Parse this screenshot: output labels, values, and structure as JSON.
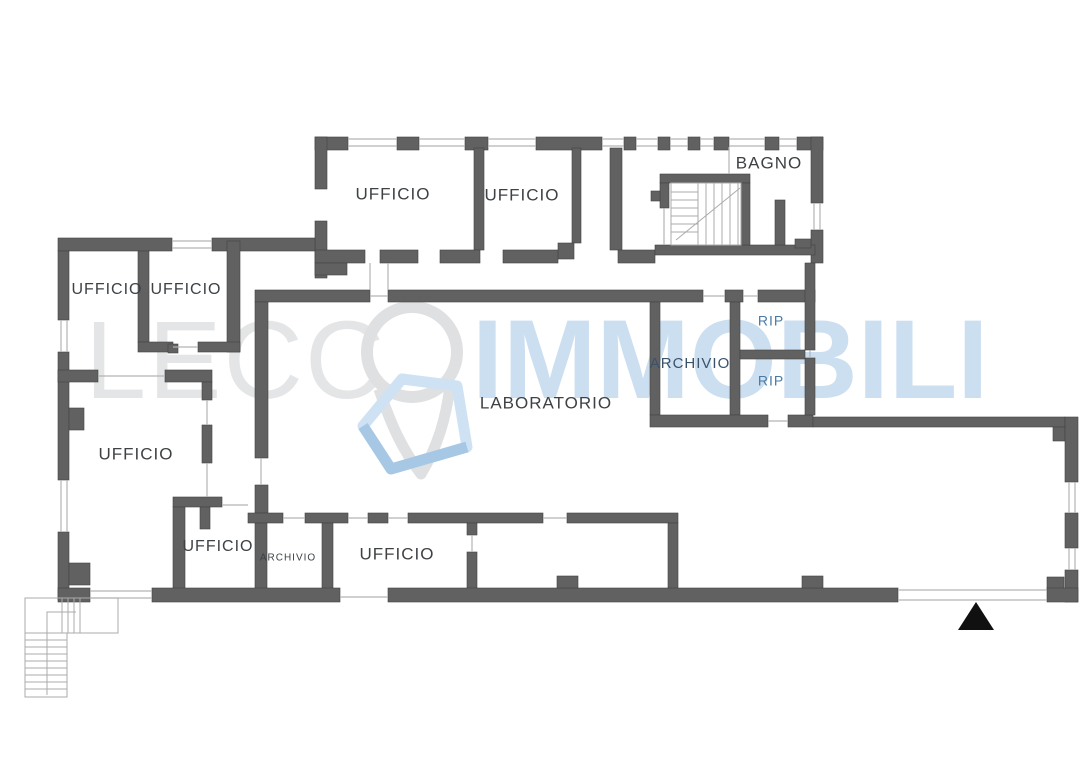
{
  "canvas": {
    "w": 1086,
    "h": 768,
    "bg": "#ffffff"
  },
  "watermark": {
    "word_gray": "LECC",
    "word_blue": "IMMOBILI",
    "gray_color": "#e4e5e6",
    "blue_color": "#cbdff1",
    "pin_color": "#dfe0e2",
    "house_light": "#cfe2f3",
    "house_dark": "#a6c8e5"
  },
  "colors": {
    "wall": "#616161",
    "wall_stroke": "#424242",
    "thin": "#b3b3b3",
    "stair": "#ababab",
    "label": "#3e4245",
    "label_blue": "#4a7ba6",
    "label_slate": "#3a536b",
    "triangle": "#101010"
  },
  "rooms": [
    {
      "label": "UFFICIO",
      "x": 393,
      "y": 195,
      "size": 17,
      "color": "label"
    },
    {
      "label": "UFFICIO",
      "x": 522,
      "y": 196,
      "size": 17,
      "color": "label"
    },
    {
      "label": "BAGNO",
      "x": 769,
      "y": 164,
      "size": 17,
      "color": "label"
    },
    {
      "label": "UFFICIO",
      "x": 107,
      "y": 290,
      "size": 16,
      "color": "label"
    },
    {
      "label": "UFFICIO",
      "x": 186,
      "y": 290,
      "size": 16,
      "color": "label"
    },
    {
      "label": "UFFICIO",
      "x": 136,
      "y": 455,
      "size": 17,
      "color": "label"
    },
    {
      "label": "LABORATORIO",
      "x": 546,
      "y": 404,
      "size": 17,
      "color": "label"
    },
    {
      "label": "ARCHIVIO",
      "x": 690,
      "y": 364,
      "size": 15,
      "color": "label_slate"
    },
    {
      "label": "RIP",
      "x": 771,
      "y": 322,
      "size": 14,
      "color": "label_blue"
    },
    {
      "label": "RIP",
      "x": 771,
      "y": 382,
      "size": 14,
      "color": "label_blue"
    },
    {
      "label": "UFFICIO",
      "x": 218,
      "y": 547,
      "size": 16,
      "color": "label"
    },
    {
      "label": "ARCHIVIO",
      "x": 288,
      "y": 558,
      "size": 10,
      "color": "label"
    },
    {
      "label": "UFFICIO",
      "x": 397,
      "y": 555,
      "size": 17,
      "color": "label"
    }
  ],
  "floorplan": {
    "walls": [
      [
        315,
        137,
        33,
        13
      ],
      [
        397,
        137,
        22,
        13
      ],
      [
        465,
        137,
        23,
        13
      ],
      [
        536,
        137,
        66,
        13
      ],
      [
        624,
        137,
        12,
        13
      ],
      [
        658,
        137,
        12,
        13
      ],
      [
        688,
        137,
        12,
        13
      ],
      [
        714,
        137,
        15,
        13
      ],
      [
        765,
        137,
        14,
        13
      ],
      [
        797,
        137,
        26,
        13
      ],
      [
        315,
        137,
        12,
        52
      ],
      [
        315,
        221,
        12,
        57
      ],
      [
        811,
        137,
        12,
        66
      ],
      [
        811,
        230,
        12,
        33
      ],
      [
        474,
        148,
        10,
        102
      ],
      [
        572,
        148,
        9,
        95
      ],
      [
        558,
        243,
        16,
        16
      ],
      [
        610,
        148,
        12,
        102
      ],
      [
        315,
        250,
        50,
        13
      ],
      [
        380,
        250,
        38,
        13
      ],
      [
        440,
        250,
        40,
        13
      ],
      [
        503,
        250,
        55,
        13
      ],
      [
        618,
        250,
        37,
        13
      ],
      [
        655,
        245,
        160,
        10
      ],
      [
        660,
        174,
        90,
        9
      ],
      [
        660,
        183,
        9,
        25
      ],
      [
        741,
        183,
        9,
        62
      ],
      [
        651,
        191,
        9,
        10
      ],
      [
        775,
        200,
        10,
        45
      ],
      [
        795,
        239,
        16,
        9
      ],
      [
        58,
        238,
        114,
        13
      ],
      [
        212,
        238,
        103,
        13
      ],
      [
        315,
        263,
        32,
        12
      ],
      [
        58,
        251,
        11,
        69
      ],
      [
        58,
        352,
        11,
        128
      ],
      [
        58,
        532,
        11,
        68
      ],
      [
        69,
        408,
        15,
        22
      ],
      [
        69,
        563,
        21,
        22
      ],
      [
        138,
        251,
        11,
        91
      ],
      [
        227,
        241,
        13,
        111
      ],
      [
        138,
        342,
        35,
        10
      ],
      [
        198,
        342,
        42,
        10
      ],
      [
        168,
        344,
        10,
        9
      ],
      [
        58,
        370,
        40,
        12
      ],
      [
        165,
        370,
        47,
        12
      ],
      [
        202,
        382,
        10,
        18
      ],
      [
        202,
        425,
        10,
        38
      ],
      [
        173,
        497,
        49,
        10
      ],
      [
        173,
        507,
        12,
        86
      ],
      [
        200,
        507,
        10,
        22
      ],
      [
        255,
        290,
        115,
        12
      ],
      [
        388,
        290,
        315,
        12
      ],
      [
        725,
        290,
        18,
        12
      ],
      [
        758,
        290,
        57,
        12
      ],
      [
        255,
        302,
        13,
        156
      ],
      [
        255,
        485,
        13,
        28
      ],
      [
        248,
        513,
        35,
        10
      ],
      [
        305,
        513,
        43,
        10
      ],
      [
        368,
        513,
        20,
        10
      ],
      [
        408,
        513,
        135,
        10
      ],
      [
        567,
        513,
        111,
        10
      ],
      [
        255,
        523,
        12,
        70
      ],
      [
        322,
        523,
        11,
        70
      ],
      [
        467,
        523,
        10,
        12
      ],
      [
        467,
        552,
        10,
        41
      ],
      [
        668,
        523,
        10,
        70
      ],
      [
        650,
        302,
        10,
        113
      ],
      [
        730,
        302,
        10,
        113
      ],
      [
        740,
        350,
        65,
        9
      ],
      [
        650,
        415,
        118,
        12
      ],
      [
        788,
        415,
        25,
        12
      ],
      [
        805,
        263,
        10,
        87
      ],
      [
        805,
        358,
        10,
        57
      ],
      [
        813,
        417,
        252,
        10
      ],
      [
        1053,
        427,
        12,
        14
      ],
      [
        1047,
        577,
        17,
        13
      ],
      [
        1065,
        417,
        13,
        65
      ],
      [
        1065,
        513,
        13,
        35
      ],
      [
        1065,
        570,
        13,
        32
      ],
      [
        58,
        588,
        32,
        14
      ],
      [
        152,
        588,
        188,
        14
      ],
      [
        388,
        588,
        510,
        14
      ],
      [
        1047,
        588,
        31,
        14
      ],
      [
        557,
        576,
        21,
        12
      ],
      [
        802,
        576,
        21,
        12
      ]
    ],
    "thin_h": [
      [
        348,
        397,
        139
      ],
      [
        348,
        397,
        146
      ],
      [
        419,
        465,
        139
      ],
      [
        419,
        465,
        146
      ],
      [
        488,
        536,
        139
      ],
      [
        488,
        536,
        146
      ],
      [
        602,
        624,
        139
      ],
      [
        602,
        624,
        146
      ],
      [
        636,
        658,
        139
      ],
      [
        636,
        658,
        146
      ],
      [
        670,
        688,
        139
      ],
      [
        670,
        688,
        146
      ],
      [
        700,
        714,
        139
      ],
      [
        700,
        714,
        146
      ],
      [
        729,
        765,
        139
      ],
      [
        729,
        765,
        146
      ],
      [
        779,
        797,
        139
      ],
      [
        779,
        797,
        146
      ],
      [
        172,
        212,
        241
      ],
      [
        172,
        212,
        248
      ],
      [
        90,
        152,
        591
      ],
      [
        90,
        152,
        598
      ],
      [
        340,
        388,
        597
      ],
      [
        898,
        1047,
        590
      ],
      [
        898,
        1047,
        600
      ],
      [
        98,
        165,
        376
      ],
      [
        173,
        198,
        347
      ],
      [
        222,
        248,
        505
      ],
      [
        283,
        305,
        518
      ],
      [
        348,
        368,
        518
      ],
      [
        388,
        408,
        518
      ],
      [
        543,
        567,
        518
      ],
      [
        768,
        788,
        421
      ],
      [
        370,
        388,
        296
      ],
      [
        703,
        725,
        296
      ],
      [
        743,
        758,
        296
      ]
    ],
    "thin_v": [
      [
        61,
        320,
        352
      ],
      [
        67,
        320,
        352
      ],
      [
        61,
        480,
        532
      ],
      [
        67,
        480,
        532
      ],
      [
        814,
        203,
        230
      ],
      [
        820,
        203,
        230
      ],
      [
        1069,
        482,
        513
      ],
      [
        1075,
        482,
        513
      ],
      [
        1069,
        548,
        570
      ],
      [
        1075,
        548,
        570
      ],
      [
        729,
        147,
        174
      ],
      [
        370,
        263,
        290
      ],
      [
        388,
        263,
        290
      ],
      [
        261,
        458,
        485
      ],
      [
        207,
        400,
        425
      ],
      [
        207,
        463,
        497
      ],
      [
        472,
        535,
        552
      ],
      [
        810,
        350,
        358
      ],
      [
        664,
        208,
        245
      ]
    ],
    "stairwell": {
      "inner": [
        671,
        183,
        70,
        62
      ],
      "v_lines": [
        698,
        706,
        714,
        722,
        730,
        738
      ],
      "v_span": [
        183,
        245
      ],
      "h_lines": [
        192,
        200,
        208,
        216,
        224,
        232
      ],
      "h_span": [
        671,
        698
      ],
      "diag": [
        676,
        240,
        740,
        188
      ]
    },
    "ext_stairs": {
      "landing": [
        25,
        598,
        93,
        35
      ],
      "run": [
        25,
        633,
        42,
        64
      ],
      "run_lines_y": [
        640,
        647,
        654,
        661,
        668,
        675,
        682,
        689
      ],
      "run_span": [
        25,
        67
      ],
      "landing_lines_x": [
        62,
        68,
        74,
        80
      ],
      "landing_span": [
        598,
        633
      ],
      "rail": [
        [
          47,
          695
        ],
        [
          47,
          612
        ],
        [
          76,
          612
        ]
      ]
    },
    "triangle": [
      [
        958,
        630
      ],
      [
        994,
        630
      ],
      [
        976,
        602
      ]
    ]
  }
}
